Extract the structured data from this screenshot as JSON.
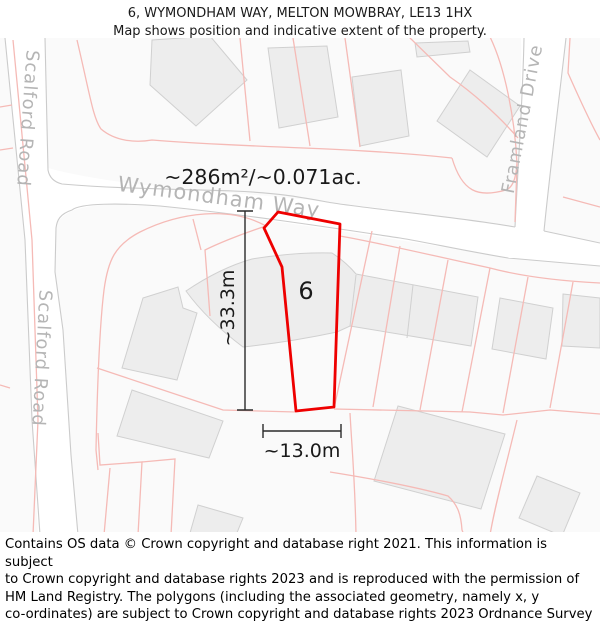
{
  "header": {
    "title_line1": "6, WYMONDHAM WAY, MELTON MOWBRAY, LE13 1HX",
    "title_line2": "Map shows position and indicative extent of the property."
  },
  "map": {
    "area_label": "~286m²/~0.071ac.",
    "plot_number": "6",
    "height_label": "~33.3m",
    "width_label": "~13.0m",
    "streets": {
      "wymondham_way": "Wymondham Way",
      "scalford_road_upper": "Scalford Road",
      "scalford_road_lower": "Scalford Road",
      "framland_drive": "Framland Drive"
    },
    "colors": {
      "plot_outline": "#ee0000",
      "parcel_line": "#f5bab6",
      "road_line": "#cbcbcb",
      "building_fill": "#ededed",
      "building_stroke": "#d0d0d0",
      "street_label": "#b5b5b5",
      "measure": "#2a2a2a"
    }
  },
  "footer": {
    "lines": [
      "Contains OS data © Crown copyright and database right 2021. This information is subject",
      "to Crown copyright and database rights 2023 and is reproduced with the permission of",
      "HM Land Registry. The polygons (including the associated geometry, namely x, y",
      "co-ordinates) are subject to Crown copyright and database rights 2023 Ordnance Survey",
      "100026316."
    ]
  }
}
